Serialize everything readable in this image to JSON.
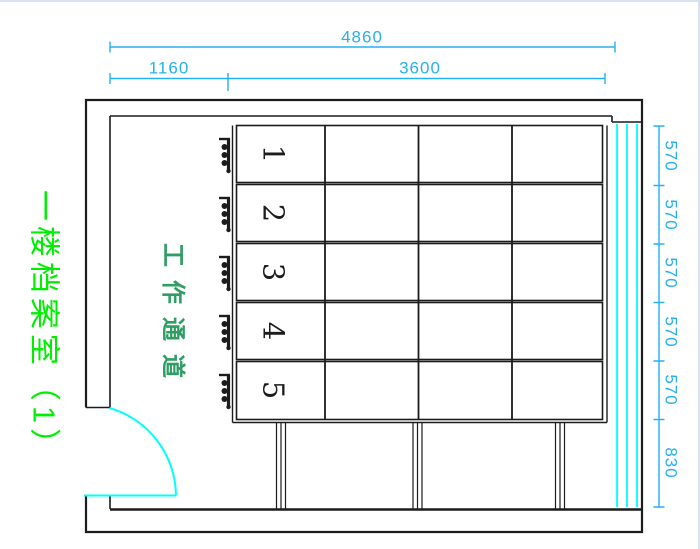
{
  "drawing_title": {
    "text": "一楼档案室（1）",
    "color": "#00ef00"
  },
  "corridor_label": {
    "text": "工作通道",
    "color": "#2f9e63"
  },
  "shelving": {
    "column_count": 4,
    "rows": [
      {
        "label": "1"
      },
      {
        "label": "2"
      },
      {
        "label": "3"
      },
      {
        "label": "4"
      },
      {
        "label": "5"
      }
    ]
  },
  "dimensions": {
    "top": [
      {
        "value": "4860"
      },
      {
        "value": "1160"
      },
      {
        "value": "3600"
      }
    ],
    "right": [
      {
        "value": "570"
      },
      {
        "value": "570"
      },
      {
        "value": "570"
      },
      {
        "value": "570"
      },
      {
        "value": "570"
      },
      {
        "value": "830"
      }
    ]
  },
  "colors": {
    "ink": "#1c1c1c",
    "dim": "#25b1f0",
    "cyan": "#00ffff",
    "title-green": "#00ef00",
    "corridor-green": "#2f9e63",
    "edge": "#d9e2f2"
  }
}
